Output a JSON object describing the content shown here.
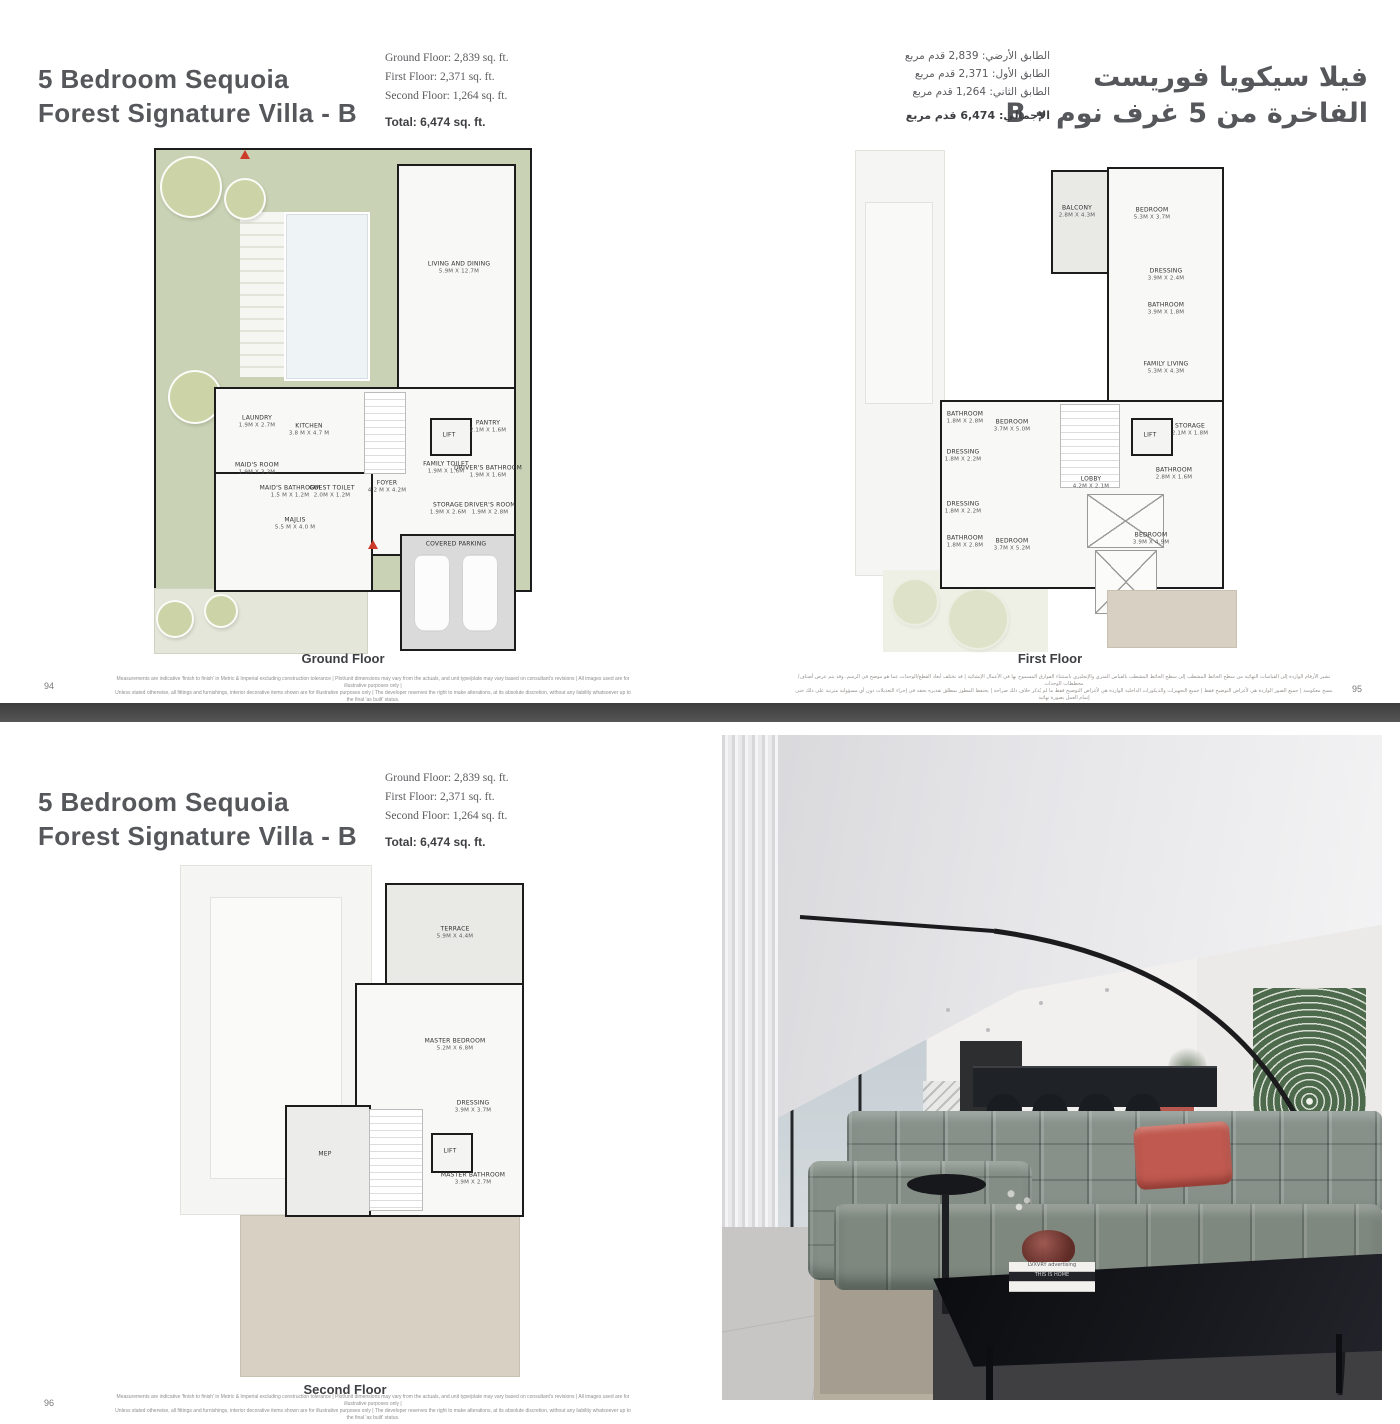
{
  "title_en": {
    "line1": "5 Bedroom Sequoia",
    "line2": "Forest Signature Villa - B"
  },
  "title_ar": {
    "line1": "فيلا سيكويا فوريست",
    "line2": "الفاخرة من 5 غرف نوم - B"
  },
  "areas_en": {
    "ground": "Ground Floor: 2,839 sq. ft.",
    "first": "First Floor: 2,371 sq. ft.",
    "second": "Second Floor: 1,264 sq. ft.",
    "total": "Total: 6,474 sq. ft."
  },
  "areas_ar": {
    "ground": "الطابق الأرضي: 2,839 قدم مربع",
    "first": "الطابق الأول: 2,371 قدم مربع",
    "second": "الطابق الثاني: 1,264 قدم مربع",
    "total": "الإجمالي: 6,474 قدم مربع"
  },
  "floors": {
    "ground": {
      "caption": "Ground Floor",
      "rooms": [
        {
          "name": "LIVING AND DINING",
          "dims": "5.9M X 12.7M"
        },
        {
          "name": "KITCHEN",
          "dims": "3.8 M X 4.7 M"
        },
        {
          "name": "LAUNDRY",
          "dims": "1.9M X 2.7M"
        },
        {
          "name": "MAID'S ROOM",
          "dims": "1.9M X 3.2M"
        },
        {
          "name": "MAID'S BATHROOM",
          "dims": "1.5 M X 1.2M"
        },
        {
          "name": "GUEST TOILET",
          "dims": "2.0M X 1.2M"
        },
        {
          "name": "MAJLIS",
          "dims": "5.5 M X 4.0 M"
        },
        {
          "name": "FOYER",
          "dims": "4.2 M X 4.2M"
        },
        {
          "name": "LIFT",
          "dims": ""
        },
        {
          "name": "PANTRY",
          "dims": "2.1M X 1.6M"
        },
        {
          "name": "FAMILY TOILET",
          "dims": "1.9M X 1.6M"
        },
        {
          "name": "DRIVER'S BATHROOM",
          "dims": "1.9M X 1.6M"
        },
        {
          "name": "STORAGE",
          "dims": "1.9M X 2.6M"
        },
        {
          "name": "DRIVER'S ROOM",
          "dims": "1.9M X 2.8M"
        },
        {
          "name": "COVERED PARKING",
          "dims": ""
        }
      ]
    },
    "first": {
      "caption": "First Floor",
      "rooms": [
        {
          "name": "BALCONY",
          "dims": "2.8M X 4.3M"
        },
        {
          "name": "BEDROOM",
          "dims": "5.3M X 3.7M"
        },
        {
          "name": "DRESSING",
          "dims": "3.9M X 2.4M"
        },
        {
          "name": "BATHROOM",
          "dims": "3.9M X 1.8M"
        },
        {
          "name": "FAMILY LIVING",
          "dims": "5.3M X 4.3M"
        },
        {
          "name": "BATHROOM",
          "dims": "1.8M X 2.8M"
        },
        {
          "name": "BEDROOM",
          "dims": "3.7M X 5.0M"
        },
        {
          "name": "DRESSING",
          "dims": "1.8M X 2.2M"
        },
        {
          "name": "DRESSING",
          "dims": "1.8M X 2.2M"
        },
        {
          "name": "BATHROOM",
          "dims": "1.8M X 2.8M"
        },
        {
          "name": "BEDROOM",
          "dims": "3.7M X 5.2M"
        },
        {
          "name": "LOBBY",
          "dims": "4.2M X 2.1M"
        },
        {
          "name": "LIFT",
          "dims": ""
        },
        {
          "name": "STORAGE",
          "dims": "2.1M X 1.8M"
        },
        {
          "name": "BATHROOM",
          "dims": "2.8M X 1.6M"
        },
        {
          "name": "BEDROOM",
          "dims": "3.9M X 4.9M"
        }
      ]
    },
    "second": {
      "caption": "Second Floor",
      "rooms": [
        {
          "name": "TERRACE",
          "dims": "5.9M X 4.4M"
        },
        {
          "name": "MASTER BEDROOM",
          "dims": "5.2M X 6.8M"
        },
        {
          "name": "DRESSING",
          "dims": "3.9M X 3.7M"
        },
        {
          "name": "LIFT",
          "dims": ""
        },
        {
          "name": "MASTER BATHROOM",
          "dims": "3.9M X 2.7M"
        },
        {
          "name": "MEP",
          "dims": ""
        }
      ]
    }
  },
  "footers": {
    "page_94": "94",
    "page_95": "95",
    "page_96": "96",
    "en_line1": "Measurements are indicative 'finish to finish' in Metric & Imperial excluding construction tolerance | Plot/unit dimensions may vary from the actuals, and unit type/plate may vary based on consultant's revisions | All images used are for illustrative purposes only |",
    "en_line2": "Unless stated otherwise, all fittings and furnishings, interior decorative items shown are for illustrative purposes only | The developer reserves the right to make alterations, at its absolute discretion, without any liability whatsoever up to the final 'as built' status.",
    "ar_line1": "تشير الأرقام الواردة إلى القياسات النهائية من سطح الحائط المشطب إلى سطح الحائط المشطب بالقياس المتري والإنجليزي باستثناء الفوارق المسموح بها في الأعمال الإنشائية | قد تختلف أبعاد القطع/الوحدات عما هو موضح في الرسم، وقد يتم عرض أصناف/مخططات الوحدات",
    "ar_line2": "بنسخ معكوسة | جميع الصور الواردة هي لأغراض التوضيح فقط | جميع التجهيزات والديكورات الداخلية الواردة هي لأغراض التوضيح فقط ما لم يُذكر خلاف ذلك صراحة | يحتفظ المطور بمطلق تقديره بحقه في إجراء التعديلات دون أي مسؤولية مترتبة على ذلك حتى إتمام العمل بصورة نهائية"
  },
  "photo": {
    "book_top": "LVXVRY advertising",
    "book_mid": "THIS IS HOME"
  },
  "colors": {
    "accent_red": "#ce3a2a",
    "garden_green": "#c9d2b4",
    "divider_gray": "#4a4a4a",
    "sofa_green": "#87918a",
    "cushion_coral": "#c05a50"
  }
}
